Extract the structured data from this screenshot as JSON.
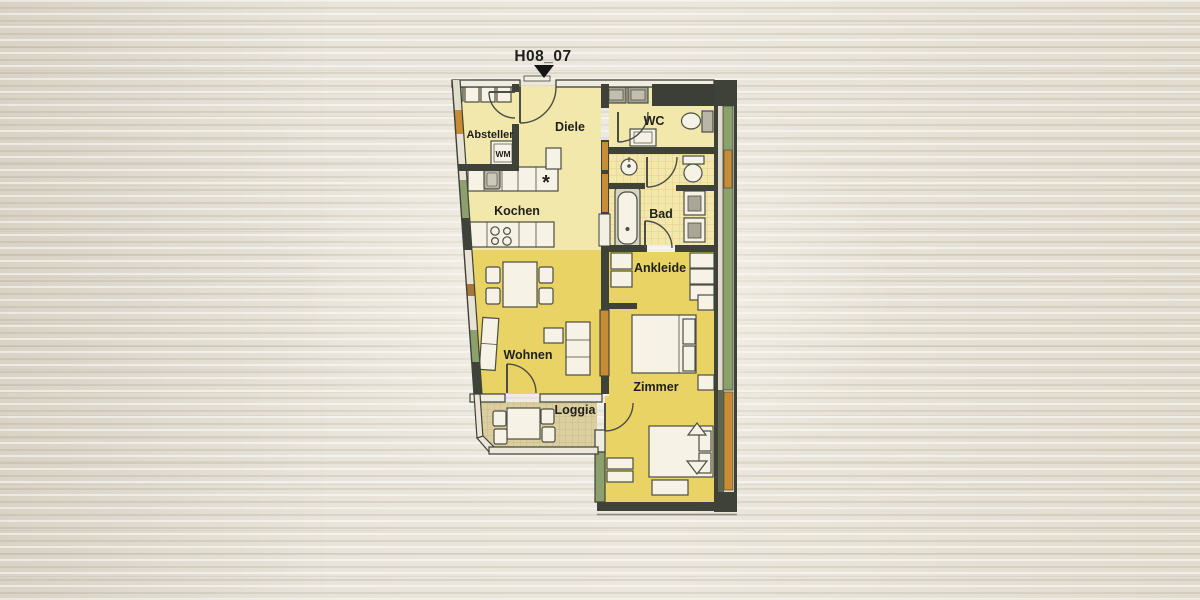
{
  "title": {
    "label": "H08_07"
  },
  "rooms": {
    "absteller": "Absteller",
    "diele": "Diele",
    "wc": "WC",
    "kochen": "Kochen",
    "bad": "Bad",
    "ankleide": "Ankleide",
    "wohnen": "Wohnen",
    "zimmer": "Zimmer",
    "loggia": "Loggia"
  },
  "annotations": {
    "washing_machine": "WM",
    "freezer_symbol": "*"
  },
  "palette": {
    "paper": "#e8e3d9",
    "room_pale_yellow": "#f2e8ab",
    "room_bright_yellow": "#e9d364",
    "loggia_floor": "#dccf9f",
    "wall_dark": "#3e4238",
    "wall_green": "#8ca06d",
    "wall_orange": "#c98c36",
    "furniture_fill": "#f6f2e5"
  }
}
